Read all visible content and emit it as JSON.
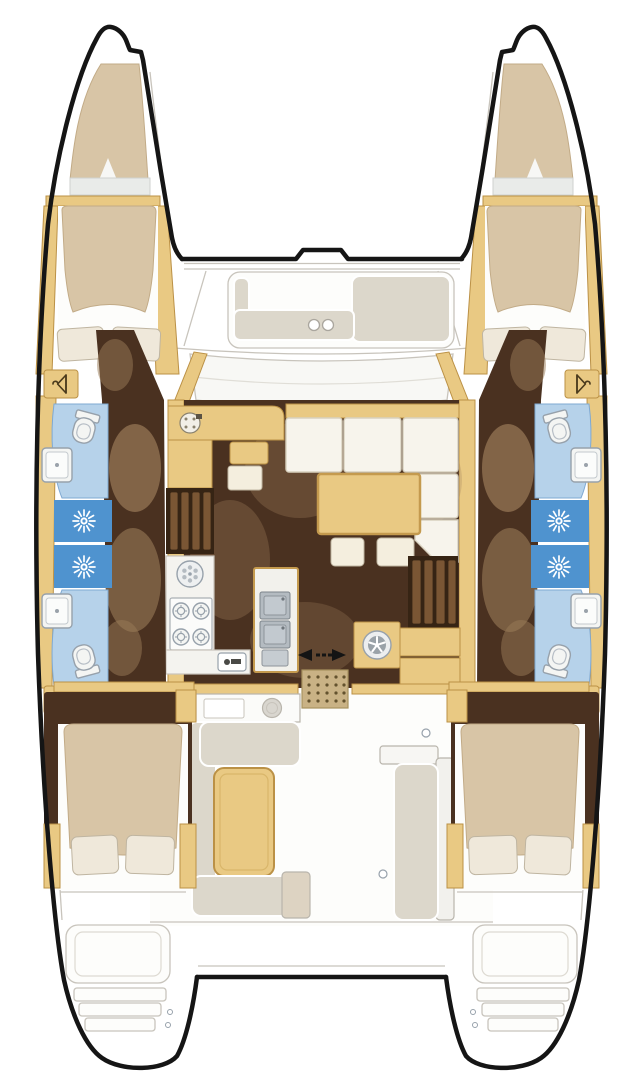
{
  "meta": {
    "description": "Top-down interior floor plan of a 4-cabin sailing catamaran (two hulls, central salon, aft cockpit)",
    "canvas": {
      "width": 643,
      "height": 1080
    }
  },
  "palette": {
    "hull_outline": "#151515",
    "deck_line": "#c8c4bc",
    "deck_fill": "#fdfdfb",
    "panel_white": "#f8f8f5",
    "wood": "#e9c983",
    "wood_dark": "#bb9146",
    "floor_dark": "#4a3120",
    "floor_shadow": "#9a7b58",
    "steps_dark": "#362414",
    "slat": "#7a5634",
    "cushion": "#d8c5a6",
    "cushion_line": "#c2ab87",
    "pillow": "#efe8da",
    "pillow_line": "#bfb5a1",
    "bath_floor": "#b6d2ea",
    "bath_line": "#7fa9d2",
    "shower": "#4f93cf",
    "fixture": "#f4f5f3",
    "fixture_line": "#97a1ab",
    "steel": "#b4bbc1",
    "steel_dark": "#7c848b",
    "settee": "#f7f4ec",
    "settee_line": "#d8d1bf",
    "bench": "#dcd7cb",
    "bench_line": "#b9b5aa",
    "stool": "#f4eede",
    "mat": "#c9b285",
    "mat_dot": "#63522e",
    "glyph": "#4a3a1c",
    "arrow": "#141414"
  },
  "icons": [
    {
      "name": "hanger-icon",
      "meaning": "hanging locker",
      "count": 4
    },
    {
      "name": "shower-rose-icon",
      "meaning": "shower stall head",
      "count": 4
    },
    {
      "name": "toilet-icon",
      "meaning": "marine toilet",
      "count": 4
    },
    {
      "name": "washbasin-icon",
      "meaning": "head washbasin",
      "count": 4
    },
    {
      "name": "round-sink-icon",
      "meaning": "galley round sink",
      "count": 1
    },
    {
      "name": "stove-burners-icon",
      "meaning": "4-burner stove",
      "count": 1
    },
    {
      "name": "double-sink-icon",
      "meaning": "galley double sink",
      "count": 1
    },
    {
      "name": "washer-porthole-icon",
      "meaning": "washer / porthole door",
      "count": 1
    },
    {
      "name": "nav-instrument-icon",
      "meaning": "chart-table instrument",
      "count": 1
    },
    {
      "name": "sliding-door-arrows-icon",
      "meaning": "sliding salon door",
      "count": 1
    },
    {
      "name": "cup-holder-icon",
      "meaning": "foredeck seat cup holders",
      "count": 2
    },
    {
      "name": "entry-mat",
      "meaning": "dotted companionway mat",
      "count": 1
    }
  ],
  "areas": {
    "bows": [
      "port-bow-sunpad",
      "starboard-bow-sunpad"
    ],
    "cabins": [
      "port-forward-cabin",
      "port-aft-cabin",
      "starboard-forward-cabin",
      "starboard-aft-cabin"
    ],
    "heads": [
      "port-forward-head",
      "port-aft-head",
      "starboard-forward-head",
      "starboard-aft-head"
    ],
    "shower_stalls": 4,
    "salon": [
      "nav-station",
      "l-shaped-settee",
      "salon-table",
      "galley",
      "companionway-steps-port",
      "companionway-steps-starboard",
      "sliding-door"
    ],
    "cockpit": [
      "cockpit-table",
      "port-l-bench",
      "aft-bench",
      "starboard-bench"
    ],
    "foredeck": [
      "forward-cockpit-seat"
    ],
    "stern": [
      "port-transom-steps",
      "starboard-transom-steps"
    ]
  },
  "equipment_counts": {
    "stove_burners": 4,
    "galley_sinks": 2,
    "round_sinks": 1,
    "toilets": 4,
    "washbasins": 4,
    "hanging_lockers": 4,
    "shower_heads": 4,
    "double_beds": 4,
    "pillows": 8,
    "cup_holders": 2
  }
}
